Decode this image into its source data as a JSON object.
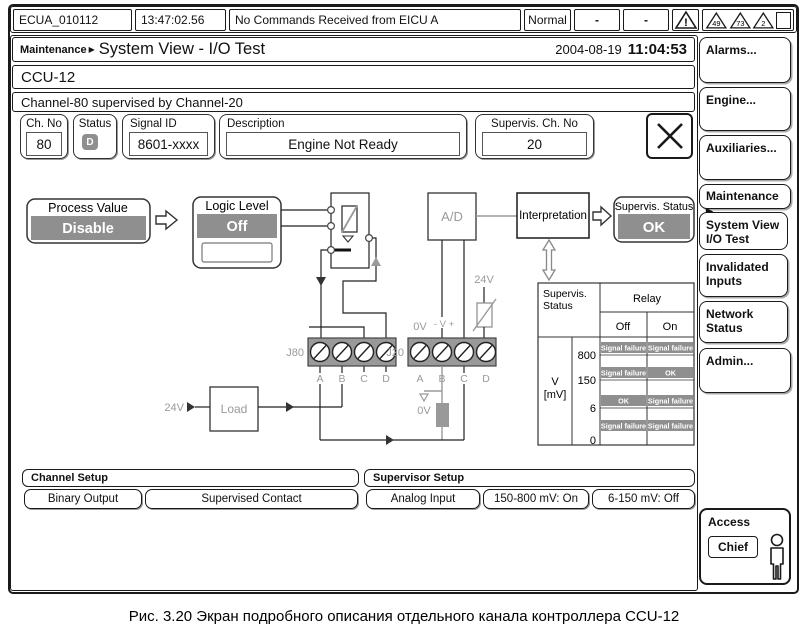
{
  "top_bar": {
    "unit": "ECUA_010112",
    "time": "13:47:02.56",
    "message": "No Commands Received from EICU A",
    "mode": "Normal",
    "col1": "-",
    "col2": "-",
    "warn": "!",
    "badges": [
      "49",
      "73",
      "2"
    ]
  },
  "header": {
    "breadcrumb": "Maintenance",
    "arrow": "▶",
    "title": "System View - I/O Test",
    "date": "2004-08-19",
    "time": "11:04:53"
  },
  "controller": "CCU-12",
  "channel_note": "Channel-80 supervised by Channel-20",
  "fields": {
    "ch_no": {
      "label": "Ch. No",
      "value": "80"
    },
    "status": {
      "label": "Status",
      "value": "D"
    },
    "signal_id": {
      "label": "Signal ID",
      "value": "8601-xxxx"
    },
    "description": {
      "label": "Description",
      "value": "Engine Not Ready"
    },
    "supervis_ch": {
      "label": "Supervis. Ch. No",
      "value": "20"
    }
  },
  "diagram": {
    "process_value": {
      "label": "Process Value",
      "value": "Disable"
    },
    "logic_level": {
      "label": "Logic Level",
      "value": "Off"
    },
    "ad": "A/D",
    "interpretation": "Interpretation",
    "supervis_status": {
      "label": "Supervis. Status",
      "value": "OK"
    },
    "load": "Load",
    "v24": "24V",
    "v0": "0V",
    "minus_v_plus": "- V +",
    "j80": "J80",
    "j20": "J20",
    "terminals": [
      "A",
      "B",
      "C",
      "D"
    ],
    "table": {
      "corner_line1": "Supervis.",
      "corner_line2": "Status",
      "relay": "Relay",
      "off": "Off",
      "on": "On",
      "axis_line1": "V",
      "axis_line2": "[mV]",
      "levels": [
        "800",
        "150",
        "6",
        "0"
      ],
      "bands": [
        [
          "Signal failure",
          "Signal failure"
        ],
        [
          "Signal failure",
          "OK"
        ],
        [
          "OK",
          "Signal failure"
        ],
        [
          "Signal failure",
          "Signal failure"
        ]
      ]
    }
  },
  "channel_setup": {
    "title": "Channel Setup",
    "buttons": [
      "Binary Output",
      "Supervised Contact"
    ]
  },
  "supervisor_setup": {
    "title": "Supervisor Setup",
    "buttons": [
      "Analog Input",
      "150-800 mV: On",
      "6-150 mV: Off"
    ]
  },
  "sidebar": {
    "alarms": "Alarms...",
    "engine": "Engine...",
    "auxiliaries": "Auxiliaries...",
    "maintenance": "Maintenance",
    "maintenance_arrow": "▶",
    "system_view_line1": "System View",
    "system_view_line2": "I/O Test",
    "invalidated_line1": "Invalidated",
    "invalidated_line2": "Inputs",
    "network_line1": "Network",
    "network_line2": "Status",
    "admin": "Admin...",
    "access": {
      "label": "Access",
      "user": "Chief"
    }
  },
  "caption": "Рис. 3.20 Экран подробного описания отдельного канала контроллера CCU-12",
  "colors": {
    "bar_gray": "#8f8f8f",
    "line_gray": "#9a9a9a"
  }
}
